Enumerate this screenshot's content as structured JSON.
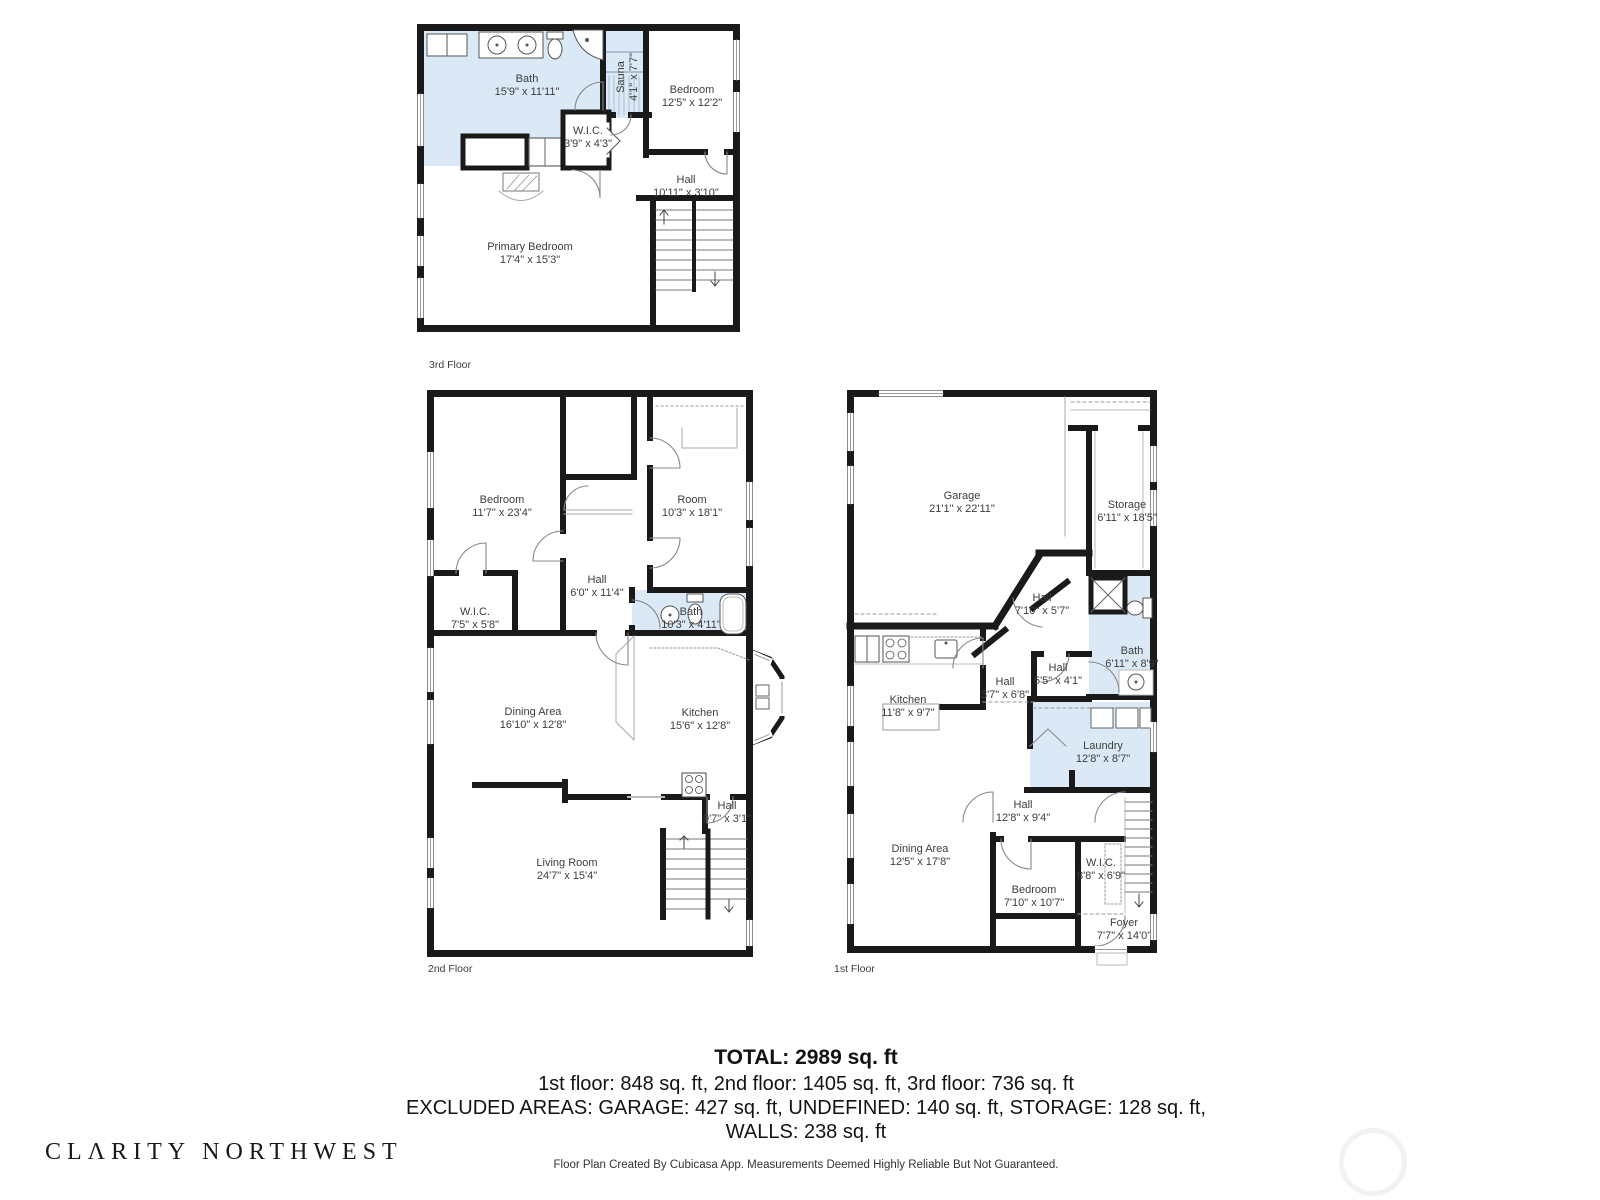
{
  "colors": {
    "wall": "#1a1a1a",
    "wet_room_fill": "#dbe9f6",
    "label_text": "#3d3d3d",
    "background": "#ffffff"
  },
  "floors": [
    {
      "caption": "3rd Floor",
      "rooms": [
        {
          "name": "Bath",
          "dims": "15'9\" x 11'11\""
        },
        {
          "name": "Sauna",
          "dims": "4'1\" x 7'7\""
        },
        {
          "name": "Bedroom",
          "dims": "12'5\" x 12'2\""
        },
        {
          "name": "W.I.C.",
          "dims": "3'9\" x 4'3\""
        },
        {
          "name": "Hall",
          "dims": "10'11\" x 3'10\""
        },
        {
          "name": "Primary Bedroom",
          "dims": "17'4\" x 15'3\""
        }
      ]
    },
    {
      "caption": "2nd Floor",
      "rooms": [
        {
          "name": "Bedroom",
          "dims": "11'7\" x 23'4\""
        },
        {
          "name": "Room",
          "dims": "10'3\" x 18'1\""
        },
        {
          "name": "Hall",
          "dims": "6'0\" x 11'4\""
        },
        {
          "name": "W.I.C.",
          "dims": "7'5\" x 5'8\""
        },
        {
          "name": "Bath",
          "dims": "10'3\" x 4'11\""
        },
        {
          "name": "Dining Area",
          "dims": "16'10\" x 12'8\""
        },
        {
          "name": "Kitchen",
          "dims": "15'6\" x 12'8\""
        },
        {
          "name": "Hall",
          "dims": "9'7\" x 3'1\""
        },
        {
          "name": "Living Room",
          "dims": "24'7\" x 15'4\""
        }
      ]
    },
    {
      "caption": "1st Floor",
      "rooms": [
        {
          "name": "Garage",
          "dims": "21'1\" x 22'11\""
        },
        {
          "name": "Storage",
          "dims": "6'11\" x 18'5\""
        },
        {
          "name": "Hall",
          "dims": "7'10\" x 5'7\""
        },
        {
          "name": "Bath",
          "dims": "6'11\" x 8'9\""
        },
        {
          "name": "Hall",
          "dims": "5'5\" x 4'1\""
        },
        {
          "name": "Hall",
          "dims": "3'7\" x 6'8\""
        },
        {
          "name": "Kitchen",
          "dims": "11'8\" x 9'7\""
        },
        {
          "name": "Laundry",
          "dims": "12'8\" x 8'7\""
        },
        {
          "name": "Hall",
          "dims": "12'8\" x 9'4\""
        },
        {
          "name": "Dining Area",
          "dims": "12'5\" x 17'8\""
        },
        {
          "name": "Bedroom",
          "dims": "7'10\" x 10'7\""
        },
        {
          "name": "W.I.C.",
          "dims": "8'8\" x 6'9\""
        },
        {
          "name": "Foyer",
          "dims": "7'7\" x 14'0\""
        }
      ]
    }
  ],
  "summary": {
    "total": "TOTAL: 2989 sq. ft",
    "floors_line": "1st floor: 848 sq. ft, 2nd floor: 1405 sq. ft, 3rd floor: 736 sq. ft",
    "excluded_line": "EXCLUDED AREAS: GARAGE: 427 sq. ft, UNDEFINED: 140 sq. ft, STORAGE: 128 sq. ft,",
    "walls_line": "WALLS: 238 sq. ft"
  },
  "branding": {
    "logo": "CLΛRITY NORTHWEST"
  },
  "disclaimer": "Floor Plan Created By Cubicasa App. Measurements Deemed Highly Reliable But Not Guaranteed."
}
